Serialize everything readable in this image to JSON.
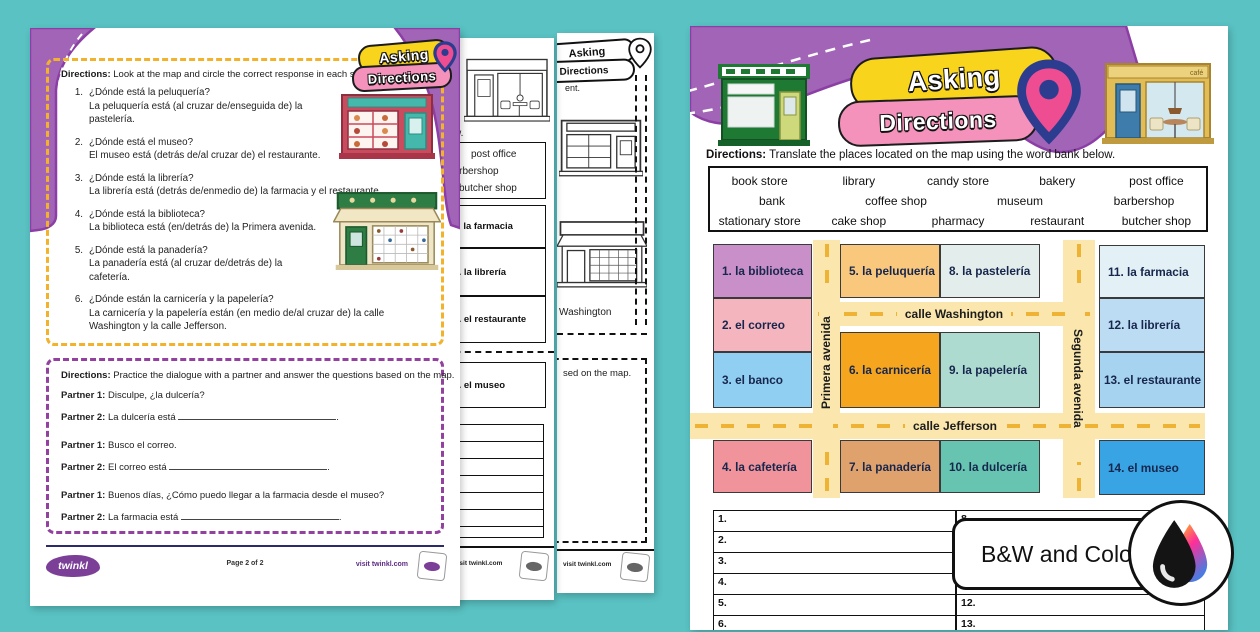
{
  "colors": {
    "background_teal": "#5ac2c3",
    "purple_wave": "#a264b6",
    "purple_outline": "#8b3fa5",
    "pill_yellow": "#f8d41c",
    "pill_pink": "#f492bb",
    "pin_navy": "#2c3c8f",
    "pin_pink": "#ee4d92",
    "road_fill": "#fbe7ad",
    "road_dash": "#eeb235",
    "yellow_dashed_border": "#f2b22b",
    "purple_dashed_border": "#93419f"
  },
  "logo": {
    "line1": "Asking",
    "line2": "Directions"
  },
  "badge": {
    "label": "B&W and Color"
  },
  "page_left": {
    "directions_label": "Directions:",
    "directions": "Look at the map and circle the correct response in each statement.",
    "questions": [
      {
        "num": "1.",
        "q": "¿Dónde está la peluquería?",
        "a": "La peluquería está (al cruzar de/enseguida de) la pastelería."
      },
      {
        "num": "2.",
        "q": "¿Dónde está el museo?",
        "a": "El museo está (detrás de/al cruzar de) el restaurante."
      },
      {
        "num": "3.",
        "q": "¿Dónde está la librería?",
        "a": "La librería está (detrás de/enmedio de) la farmacia y el restaurante."
      },
      {
        "num": "4.",
        "q": "¿Dónde está la biblioteca?",
        "a": "La biblioteca está (en/detrás de) la Primera avenida."
      },
      {
        "num": "5.",
        "q": "¿Dónde está la panadería?",
        "a": "La panadería está (al cruzar de/detrás de) la cafetería."
      },
      {
        "num": "6.",
        "q": "¿Dónde están la carnicería y la papelería?",
        "a": "La carnicería y la papelería están (en medio de/al cruzar de) la calle Washington y la calle Jefferson."
      }
    ],
    "dialogue": {
      "directions_label": "Directions:",
      "directions": "Practice the dialogue with a partner and answer the questions based on the map.",
      "lines": [
        {
          "speaker": "Partner 1:",
          "text": "Disculpe, ¿la dulcería?",
          "suffix": ""
        },
        {
          "speaker": "Partner 2:",
          "text": "La dulcería está",
          "suffix": "."
        },
        {
          "speaker": "Partner 1:",
          "text": "Busco el correo.",
          "suffix": ""
        },
        {
          "speaker": "Partner 2:",
          "text": "El correo está",
          "suffix": "."
        },
        {
          "speaker": "Partner 1:",
          "text": "Buenos días, ¿Cómo puedo llegar a la farmacia desde el museo?",
          "suffix": ""
        },
        {
          "speaker": "Partner 2:",
          "text": "La farmacia está",
          "suffix": "."
        }
      ]
    },
    "footer": {
      "brand": "twinkl",
      "page_info": "Page 2 of 2",
      "visit": "visit twinkl.com"
    }
  },
  "page_mid_a": {
    "fragment_top": "w.",
    "wordbank": [
      "post office",
      "barbershop",
      "butcher shop"
    ],
    "cells": [
      "11. la farmacia",
      "12. la librería",
      "13. el restaurante",
      "14. el museo"
    ],
    "visit": "visit twinkl.com"
  },
  "page_mid_b": {
    "logo1": "Asking",
    "logo2": "Directions",
    "fragment_statement": "ent.",
    "fragment_street": "Washington",
    "fragment_map": "sed on the map.",
    "visit": "visit twinkl.com"
  },
  "page_color": {
    "directions_label": "Directions:",
    "directions": "Translate the places located on the map using the word bank below.",
    "wordbank": [
      [
        "book store",
        "library",
        "candy store",
        "bakery",
        "post office"
      ],
      [
        "bank",
        "coffee shop",
        "museum",
        "barbershop"
      ],
      [
        "stationary store",
        "cake shop",
        "pharmacy",
        "restaurant",
        "butcher shop"
      ]
    ],
    "map": {
      "streets": {
        "washington": "calle Washington",
        "jefferson": "calle Jefferson",
        "primera": "Primera avenida",
        "segunda": "Segunda avenida"
      },
      "cells": [
        {
          "label": "1. la biblioteca",
          "color": "#c98fc9"
        },
        {
          "label": "2. el correo",
          "color": "#f5b5bf"
        },
        {
          "label": "3. el banco",
          "color": "#90cff2"
        },
        {
          "label": "4. la cafetería",
          "color": "#f0939b"
        },
        {
          "label": "5. la peluquería",
          "color": "#f9c87d"
        },
        {
          "label": "6. la carnicería",
          "color": "#f6a51f"
        },
        {
          "label": "7. la panadería",
          "color": "#e0a26d"
        },
        {
          "label": "8. la pastelería",
          "color": "#e3eeec"
        },
        {
          "label": "9. la papelería",
          "color": "#aedbd0"
        },
        {
          "label": "10.  la dulcería",
          "color": "#66c4b0"
        },
        {
          "label": "11. la farmacia",
          "color": "#e3f0f5"
        },
        {
          "label": "12. la librería",
          "color": "#bcdcf4"
        },
        {
          "label": "13. el restaurante",
          "color": "#a5d3f0"
        },
        {
          "label": "14. el museo",
          "color": "#38a4e4"
        }
      ]
    },
    "answers_left": [
      "1.",
      "2.",
      "3.",
      "4.",
      "5.",
      "6.",
      "7."
    ],
    "answers_right": [
      "8.",
      "9.",
      "10.",
      "11.",
      "12.",
      "13.",
      "14."
    ]
  }
}
